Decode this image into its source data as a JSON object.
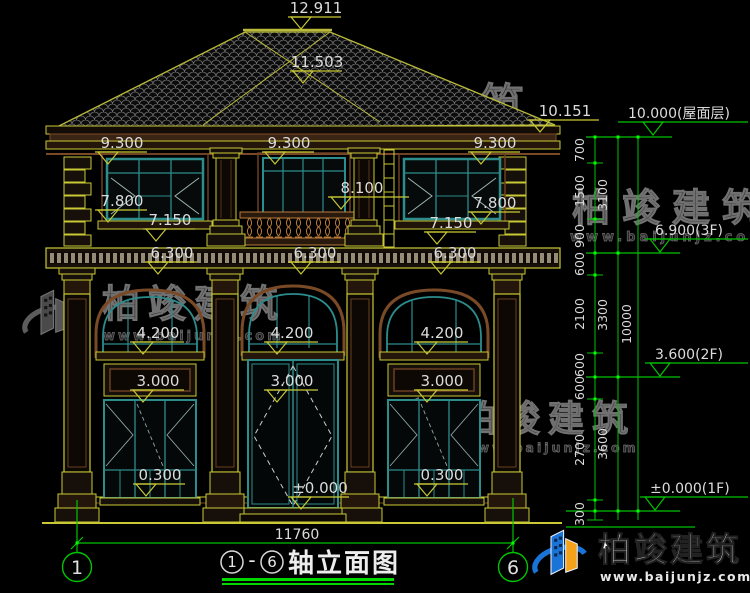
{
  "markers": {
    "m12911": "12.911",
    "m11503": "11.503",
    "m10151": "10.151",
    "m9300": "9.300",
    "m7800": "7.800",
    "m8100": "8.100",
    "m7150": "7.150",
    "m6300": "6.300",
    "m4200": "4.200",
    "m3000": "3.000",
    "m0300": "0.300",
    "m0000": "±0.000"
  },
  "levels": {
    "roof": "10.000(屋面层)",
    "f3": "6.900(3F)",
    "f2": "3.600(2F)",
    "f1": "±0.000(1F)"
  },
  "chain": {
    "c700": "700",
    "c1500": "1500",
    "c900": "900",
    "c600": "600",
    "c2100": "2100",
    "c2700": "2700",
    "c300": "300",
    "c3100": "3100",
    "c3300": "3300",
    "c3600": "3600",
    "c10000": "10000"
  },
  "footer": {
    "total_width": "11760",
    "axis_left": "1",
    "axis_right": "6",
    "title_circle_left": "1",
    "title_dash": "-",
    "title_circle_right": "6",
    "title": "轴立面图"
  },
  "watermark": {
    "brand": "柏竣建筑",
    "url": "www.baijunjz.com"
  },
  "colors": {
    "cad_yellow": "#c9c935",
    "cad_green": "#00c400",
    "teal_frame": "#2d8c8c",
    "wood_brown": "#7a4a26",
    "logo_blue": "#1a74d8",
    "logo_orange": "#f5a21b"
  }
}
